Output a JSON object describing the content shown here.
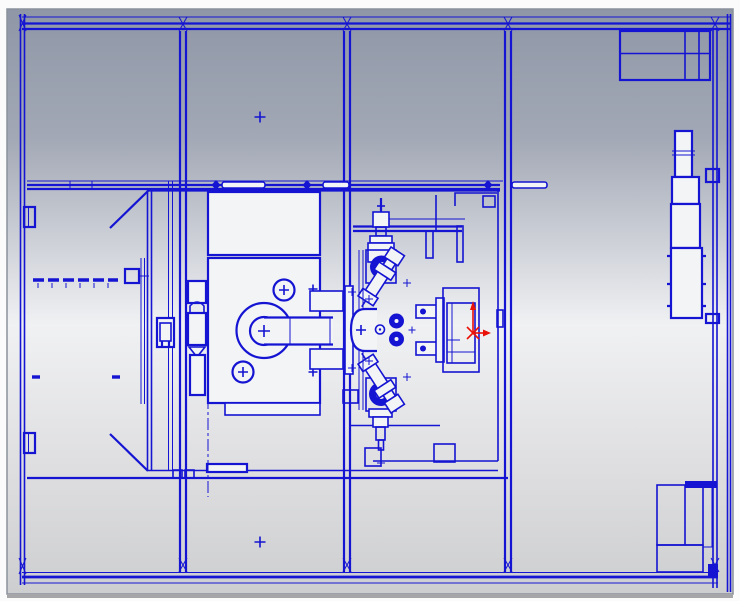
{
  "colors": {
    "blue": "#1414d2",
    "panel": "#f3f4f6",
    "red": "#ea1208",
    "bg-top": "#8f97a7",
    "bg-upper": "#a2a8b5",
    "bg-mid": "#f0f1f3",
    "bg-lower": "#dddddf",
    "bg-bottom": "#cdced0",
    "viewport-border": "#8b929c",
    "page-bg": "#fbfbfb",
    "shadow": "#a6a6a8"
  },
  "scene": {
    "kind": "cad-2d-top-view-wireframe",
    "line_color": "#1414d2",
    "origin_marker_color": "#ea1208",
    "text_items": []
  },
  "components": {
    "frame": "machine-frame-and-rails",
    "top_right_box": "electrical-cabinet",
    "right_stack": "tailstock-unit",
    "bottom_right_box": "chip-conveyor-box",
    "carriage": "carriage-slide",
    "headstock": "headstock-spindle",
    "turret": "tool-turret-assembly",
    "enclosure": "work-area-enclosure",
    "origin": "coordinate-origin-marker"
  }
}
